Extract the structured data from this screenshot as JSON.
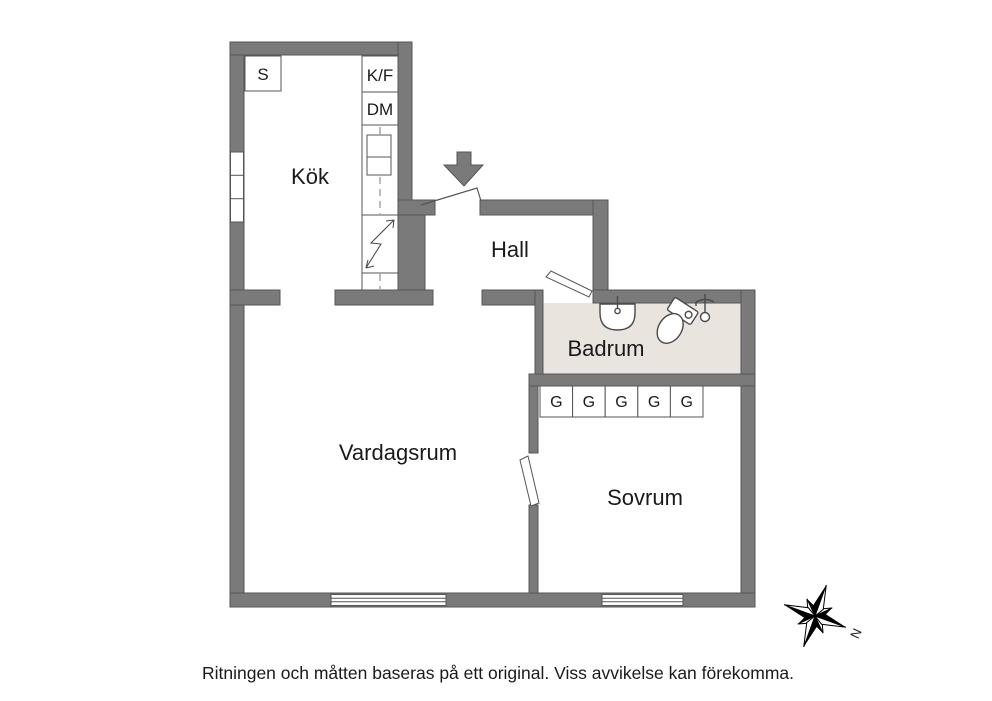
{
  "plan": {
    "rooms": {
      "kok": {
        "label": "Kök"
      },
      "hall": {
        "label": "Hall"
      },
      "badrum": {
        "label": "Badrum"
      },
      "vardagsrum": {
        "label": "Vardagsrum"
      },
      "sovrum": {
        "label": "Sovrum"
      }
    },
    "kitchen": {
      "sink_cabinet_label": "S",
      "fridge_freezer_label": "K/F",
      "dishwasher_label": "DM"
    },
    "wardrobes": [
      "G",
      "G",
      "G",
      "G",
      "G"
    ],
    "compass": {
      "north_label": "N"
    },
    "colors": {
      "wall": "#7a7a7a",
      "wall_outline": "#565656",
      "badrum_floor": "#e9e4de",
      "fixture_stroke": "#4a4a4a"
    }
  },
  "footer": {
    "disclaimer": "Ritningen och måtten baseras på ett original. Viss avvikelse kan förekomma."
  }
}
